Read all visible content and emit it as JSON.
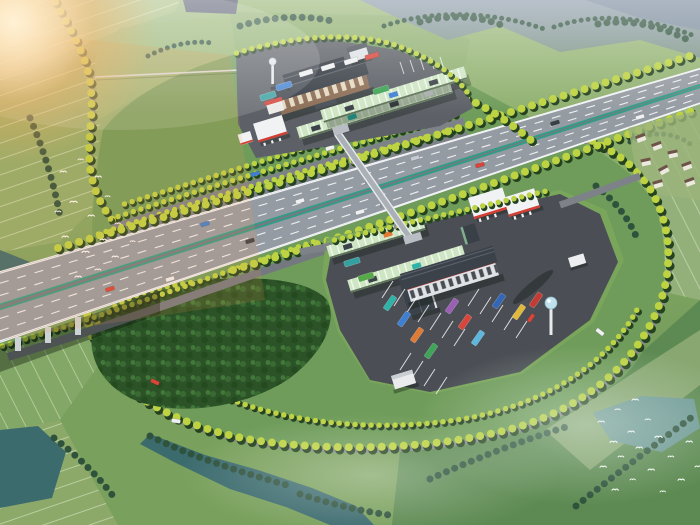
{
  "scene": {
    "description": "Aerial architectural rendering of an expressway service area: a six-lane divided highway runs diagonally across farmland, flanked by twin rest-stop complexes with dark-roofed service buildings, red-and-white gas station canopies, ribbed green truck shelters, parked coaches, water towers and a pedestrian overpass; tree-lined loop roads enclose a dense grove, rice paddies, streams and flying egrets under warm light from the upper left",
    "elements": [
      {
        "name": "expressway",
        "desc": "six-lane divided highway with teal median barriers crossing a river bridge"
      },
      {
        "name": "upper-service-building",
        "desc": "three-storey building with dark hipped roof and brick facade"
      },
      {
        "name": "lower-service-building",
        "desc": "L-shaped building with dark roof, white walls and red trim"
      },
      {
        "name": "gas-station",
        "count": 2,
        "desc": "white canopies with red fascia stripes"
      },
      {
        "name": "covered-parking-row",
        "count": 4,
        "desc": "light-green ribbed truck canopies"
      },
      {
        "name": "pedestrian-overpass",
        "desc": "footbridge linking both service areas across the highway"
      },
      {
        "name": "water-tower",
        "count": 2
      },
      {
        "name": "parked-coaches",
        "count": 12
      },
      {
        "name": "forest-grove",
        "desc": "dense grove inside the west loop"
      },
      {
        "name": "farmland",
        "desc": "rice paddies and meadows around the site"
      },
      {
        "name": "stream",
        "desc": "teal stream and ponds"
      },
      {
        "name": "egret-flock",
        "count": 2
      },
      {
        "name": "village",
        "desc": "farmhouses east of the loop"
      },
      {
        "name": "sun-flare",
        "desc": "warm glow in the upper-left corner"
      }
    ]
  },
  "palette": {
    "sun_glow": "#ffb262",
    "sun_core": "#fff3d8",
    "mountain_far": "#8d9aae",
    "mountain_green": "#7d9488",
    "field_light": "#a8bd7e",
    "field_base": "#7fa661",
    "meadow_dark": "#5d8a52",
    "loop_grass": "#6f9c5a",
    "paddy_line": "#eaf2d4",
    "water": "#3c6b6e",
    "water_light": "#6f9a97",
    "forest": "#2c5327",
    "tree_yellow": "#bdd342",
    "tree_dark": "#24421f",
    "conifer": "#2e523c",
    "road": "#83888e",
    "highway": "#959ba2",
    "apron_upper": "#5d6167",
    "apron_lower": "#4b4f55",
    "lane_white": "#f2f4f6",
    "median_teal": "#2f9e86",
    "canopy_green": "#cfe6c4",
    "roof_dark": "#3c424a",
    "wall_white": "#dfe3e6",
    "wall_brick": "#8d6f57",
    "accent_red": "#d23f35",
    "gas_white": "#f0f2f4",
    "tower_blue": "#bfe2ee"
  },
  "buses": [
    "#2fb3a8",
    "#3f7fd1",
    "#e07b35",
    "#3fa457",
    "#9a5fb5",
    "#d8453a",
    "#5db6de",
    "#3466b8",
    "#e0b93c",
    "#c43b33",
    "#35a0a0",
    "#57a84a"
  ],
  "vehicles": {
    "car_white": "#eef0f2",
    "car_red": "#d8453a",
    "car_dark": "#3a3f46",
    "car_blue": "#3f7fd1",
    "car_silver": "#c8ccd2",
    "truck_white": "#eef0f2",
    "truck_red": "#d8453a"
  }
}
